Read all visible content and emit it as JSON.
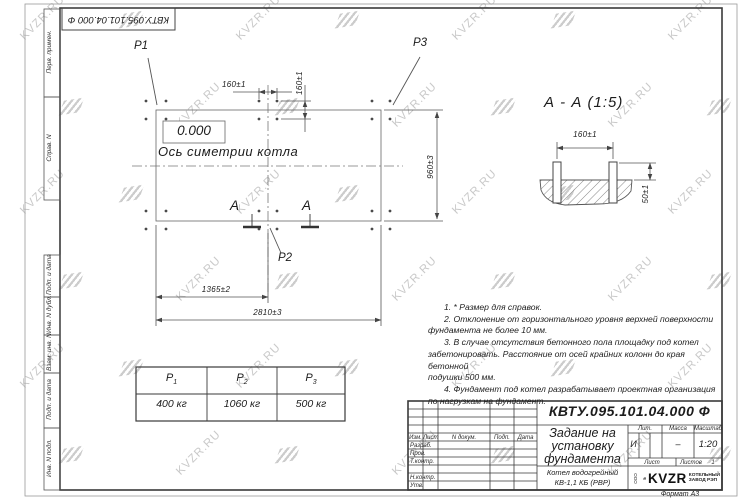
{
  "stamp": {
    "doc_number_rotated": "КВТУ.095.101.04.000 Ф"
  },
  "watermark": {
    "text": "KVZR.RU"
  },
  "margin_fields": {
    "f1": "Перв. примен.",
    "f2": "Справ. N",
    "f3": "Подп. и дата",
    "f4": "Инв. N дубл.",
    "f5": "Взам. инв. N",
    "f6": "Подп. и дата",
    "f7": "Инв. N подл."
  },
  "plan": {
    "p1": "Р1",
    "p2": "Р2",
    "p3": "Р3",
    "level_mark": "0.000",
    "axis_label": "Ось симетрии котла",
    "dim_bolt_x": "160±1",
    "dim_bolt_y": "160±1",
    "dim_width": "960±3",
    "dim_center": "1365±2",
    "dim_length": "2810±3",
    "section_letter_left": "А",
    "section_letter_right": "А"
  },
  "section": {
    "title": "А - А (1:5)",
    "dim_bolt": "160±1",
    "dim_height": "50±1"
  },
  "loads_table": {
    "col1": {
      "name": "Р",
      "sub": "1",
      "value": "400 кг"
    },
    "col2": {
      "name": "Р",
      "sub": "2",
      "value": "1060 кг"
    },
    "col3": {
      "name": "Р",
      "sub": "3",
      "value": "500 кг"
    }
  },
  "notes": {
    "line1": "1. * Размер для справок.",
    "line2": "2. Отклонение от горизонтального уровня верхней поверхности",
    "line3": "фундамента не более 10 мм.",
    "line4": "3. В случае отсутствия бетонного пола площадку под котел",
    "line5": "забетонировать. Расстояние от осей крайних колонн до края бетонной",
    "line6": "подушки 500 мм.",
    "line7": "4. Фундамент под котел разрабатывает проектная организация",
    "line8": "по нагрузкам на фундамент."
  },
  "title_block": {
    "doc_number": "КВТУ.095.101.04.000  Ф",
    "title": "Задание на установку фундамента",
    "product_line1": "Котел водогрейный",
    "product_line2": "КВ-1,1 КБ (РВР)",
    "h_izm": "Изм.",
    "h_list": "Лист",
    "h_doc": "N докум.",
    "h_sign": "Подп.",
    "h_date": "Дата",
    "r_razrab": "Разраб.",
    "r_prov": "Пров.",
    "r_tkontr": "Т.контр.",
    "r_nkontr": "Н.контр.",
    "r_utv": "Утв.",
    "h_lit": "Лит.",
    "h_mass": "Масса",
    "h_scale": "Масштаб",
    "v_lit": "И",
    "v_mass": "–",
    "v_scale": "1:20",
    "h_sheet": "Лист",
    "h_sheets": "Листов",
    "v_sheets": "1",
    "logo_prefix": "ООО",
    "logo_name": "KVZR",
    "company_line1": "КОТЕЛЬНЫЙ",
    "company_line2": "ЗАВОД РЭП",
    "format_note": "Формат А3"
  }
}
